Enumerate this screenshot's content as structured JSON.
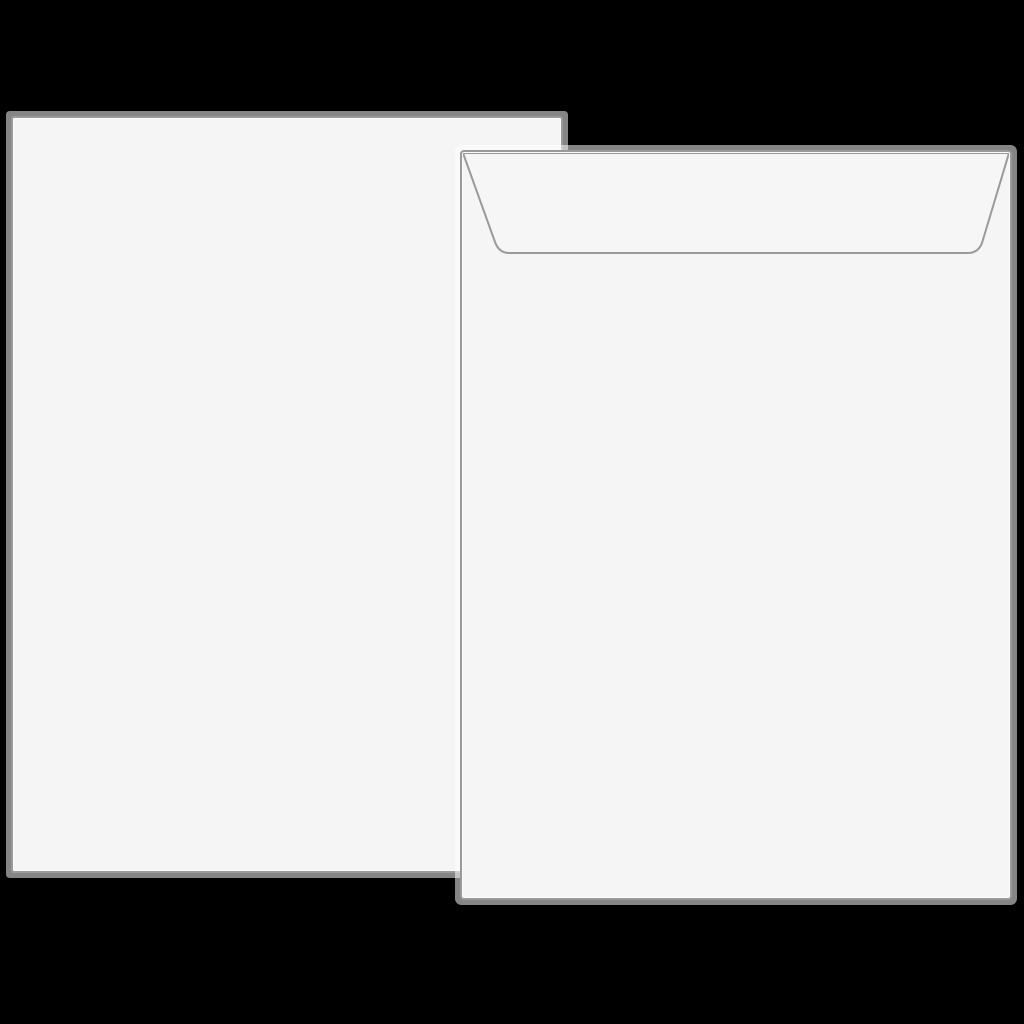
{
  "scene": {
    "description": "Blank white sheet of paper behind a sealed white envelope shown from the back, on a black background",
    "background_color": "#000000",
    "paper": {
      "object": "blank-paper-sheet",
      "fill_color": "#f5f5f6",
      "edge_stroke_color": "#9a9a9a",
      "edge_glow_color": "rgba(255,255,255,0.52)",
      "content_text": ""
    },
    "envelope": {
      "object": "envelope-back-with-sealed-flap",
      "fill_color": "#f5f5f6",
      "edge_stroke_color": "#9a9a9a",
      "flap_line_color": "#9a9a9a",
      "flap_fill_color": "#f6f6f7",
      "content_text": ""
    }
  }
}
